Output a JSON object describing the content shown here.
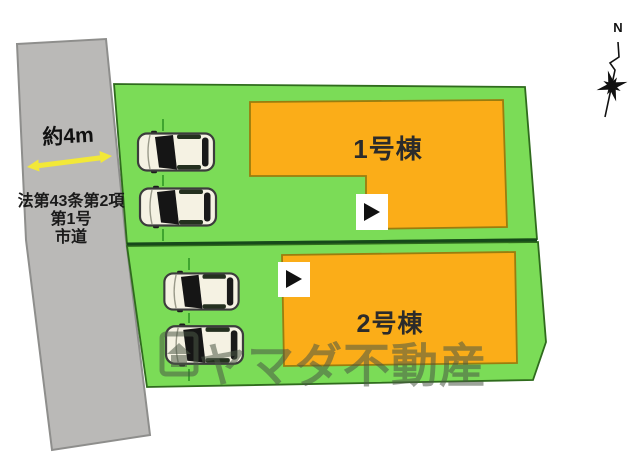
{
  "plan": {
    "road": {
      "width_label": "約4m",
      "legal_text_lines": [
        "法第43条第2項",
        "第1号",
        "市道"
      ]
    },
    "buildings": [
      {
        "label": "1号棟"
      },
      {
        "label": "2号棟"
      }
    ],
    "parking": {
      "upper_plot_cars": 2,
      "lower_plot_cars": 2
    },
    "compass": {
      "north_label": "N"
    },
    "watermark": {
      "text": "ヤマダ不動産"
    },
    "colors": {
      "plot_green": "#7BDC57",
      "plot_border": "#2F6B1D",
      "plot_divider": "#16491A",
      "building_orange": "#FBAD18",
      "building_border": "#9A7D0E",
      "building_label_text": "#2B2B2B",
      "road_gray": "#BAB9B7",
      "road_border": "#8E8E8C",
      "arrow_yellow": "#F2E838",
      "car_body": "#F5F2E3",
      "entrance_marker_bg": "#FFFFFF",
      "entrance_marker_triangle": "#111111",
      "watermark_color": "rgba(75,88,70,0.55)"
    }
  }
}
